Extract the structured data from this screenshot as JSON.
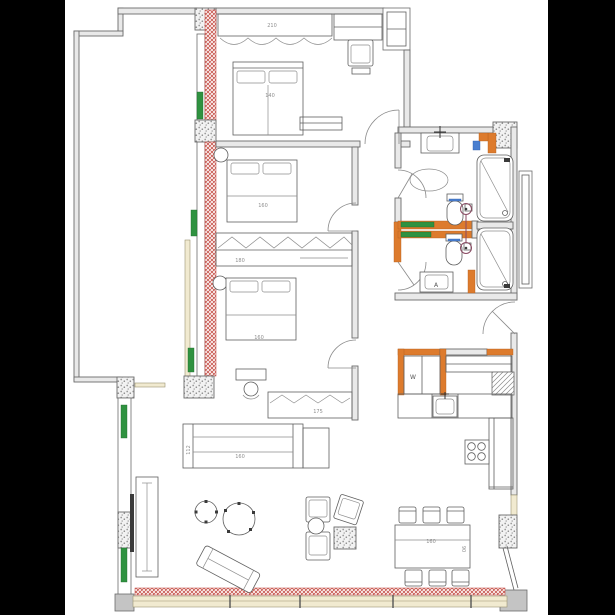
{
  "plan": {
    "title": "apartment-floor-plan",
    "labels": {
      "wardrobe_top": "210",
      "bed1": "140",
      "bed2": "160",
      "wardrobe_mid": "180",
      "bed3": "160",
      "wardrobe_bottom": "175",
      "console": "160",
      "console_side": "112",
      "dining": "160",
      "dining_side": "90",
      "washer": "W",
      "vanity": "A"
    },
    "legend_semantics": {
      "red_hatch": "new partition wall",
      "yellow_band": "window glazing",
      "green_bar": "radiator",
      "orange": "plumbing wall",
      "speckle": "structural pier"
    }
  },
  "colors": {
    "black_frame": "#000000",
    "paper": "#ffffff",
    "wall_fill": "#e9e9e9",
    "wall_line": "#6b6b6b",
    "furniture_line": "#5f5f5f",
    "new_wall_red": "#bf4138",
    "radiator_green": "#2f9240",
    "plumbing_orange": "#dd7b2d",
    "accent_blue": "#4a7fd0",
    "symbol_purple": "#8a4a62",
    "window_yellow": "#f1ead0"
  }
}
